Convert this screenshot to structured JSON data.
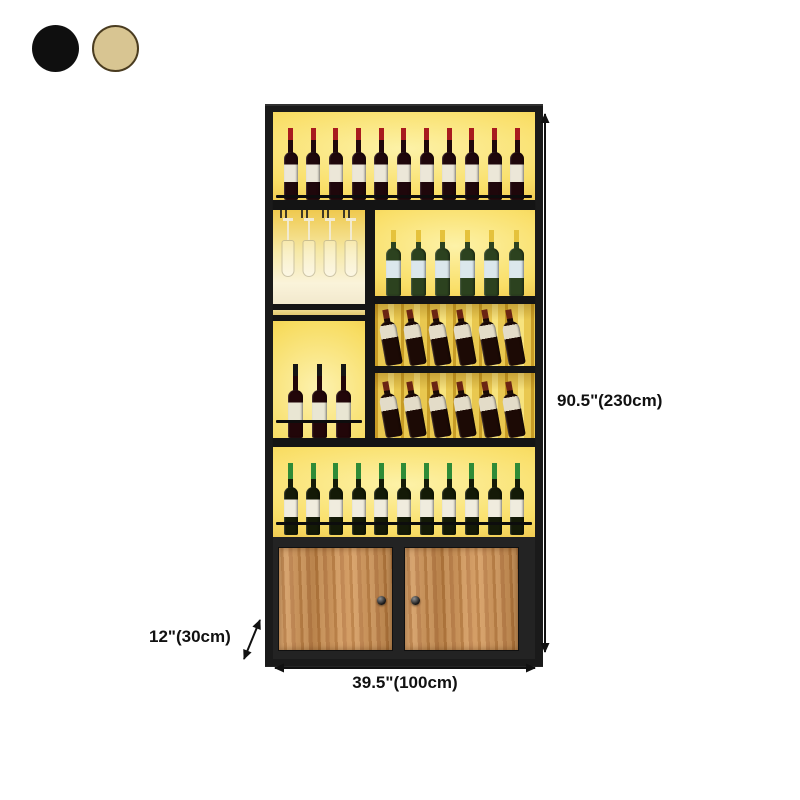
{
  "color_swatches": [
    {
      "name": "black",
      "hex": "#0f0f0f"
    },
    {
      "name": "beige",
      "hex": "#d8c592"
    }
  ],
  "dimension_labels": {
    "height": "90.5\"(230cm)",
    "width": "39.5\"(100cm)",
    "depth": "12\"(30cm)"
  },
  "cabinet": {
    "frame_color": "#1a1a1a",
    "glow_color": "#f8dd62",
    "wood_color": "#c68c50",
    "sections": {
      "top_shelf": {
        "content": "red wine bottles",
        "bottle_count": 11
      },
      "stemware_rack": {
        "content": "hanging wine glasses",
        "glass_count": 4
      },
      "white_wine_shelf": {
        "content": "white wine bottles",
        "bottle_count": 6
      },
      "tilted_rack_row1": {
        "content": "tilted wine bottles",
        "bottle_count": 6
      },
      "tilted_rack_row2": {
        "content": "tilted wine bottles",
        "bottle_count": 6
      },
      "middle_shelf": {
        "content": "red wine bottles with black caps",
        "bottle_count": 3
      },
      "bottom_shelf": {
        "content": "green-capsule wine bottles",
        "bottle_count": 11
      },
      "base_cabinet": {
        "content": "two-door wooden cabinet",
        "door_count": 2
      }
    }
  }
}
